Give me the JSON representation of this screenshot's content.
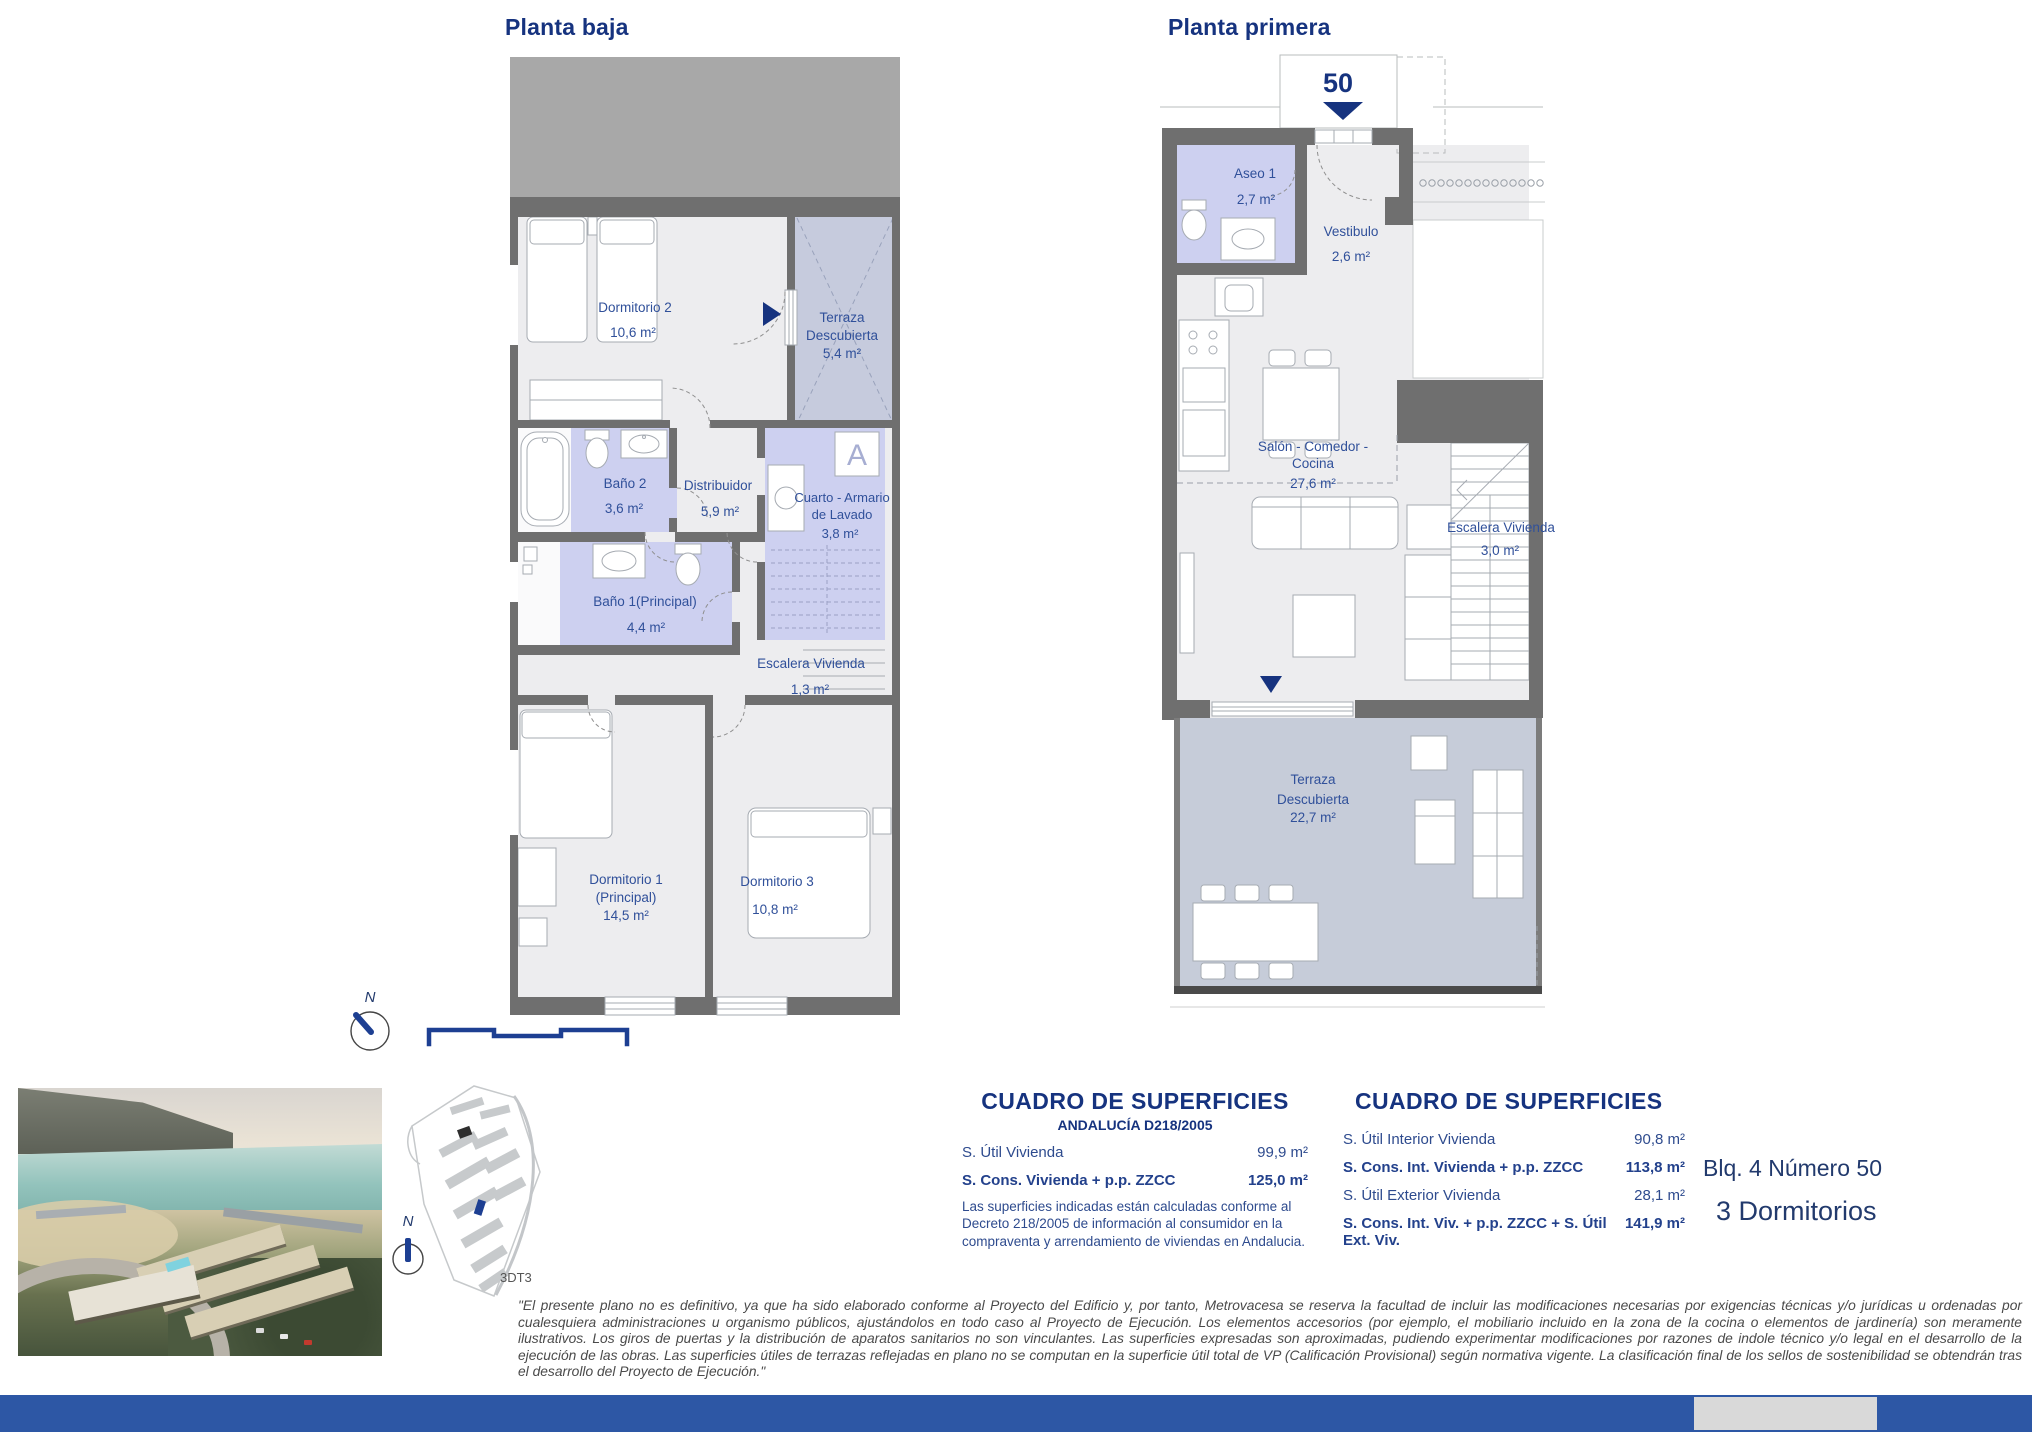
{
  "header": {
    "left_title": "Planta baja",
    "right_title": "Planta primera"
  },
  "planta_baja": {
    "north_label": "N",
    "armario_symbol": "A",
    "rooms": {
      "dormitorio2": {
        "name": "Dormitorio 2",
        "area": "10,6 m²"
      },
      "terraza": {
        "line1": "Terraza",
        "line2": "Descubierta",
        "area": "5,4 m²"
      },
      "bano2": {
        "name": "Baño 2",
        "area": "3,6 m²"
      },
      "distribuidor": {
        "name": "Distribuidor",
        "area": "5,9 m²"
      },
      "cuarto_lavado": {
        "line1": "Cuarto - Armario",
        "line2": "de Lavado",
        "area": "3,8 m²"
      },
      "bano1": {
        "name": "Baño 1(Principal)",
        "area": "4,4 m²"
      },
      "escalera": {
        "name": "Escalera Vivienda",
        "area": "1,3 m²"
      },
      "dormitorio1": {
        "line1": "Dormitorio 1",
        "line2": "(Principal)",
        "area": "14,5 m²"
      },
      "dormitorio3": {
        "name": "Dormitorio 3",
        "area": "10,8 m²"
      }
    }
  },
  "planta_primera": {
    "unit_number": "50",
    "rooms": {
      "aseo1": {
        "name": "Aseo 1",
        "area": "2,7 m²"
      },
      "vestibulo": {
        "name": "Vestibulo",
        "area": "2,6 m²"
      },
      "salon": {
        "line1": "Salón - Comedor -",
        "line2": "Cocina",
        "area": "27,6 m²"
      },
      "escalera": {
        "name": "Escalera Vivienda",
        "area": "3,0 m²"
      },
      "terraza": {
        "line1": "Terraza",
        "line2": "Descubierta",
        "area": "22,7 m²"
      }
    }
  },
  "surface_table_left": {
    "title": "CUADRO DE SUPERFICIES",
    "subtitle": "ANDALUCÍA D218/2005",
    "rows": [
      {
        "label": "S. Útil Vivienda",
        "value": "99,9 m²"
      },
      {
        "label": "S. Cons. Vivienda + p.p. ZZCC",
        "value": "125,0 m²"
      }
    ],
    "note": "Las superficies indicadas están calculadas conforme al Decreto 218/2005 de información al consumidor en la compraventa y arrendamiento de viviendas en Andalucia."
  },
  "surface_table_right": {
    "title": "CUADRO DE SUPERFICIES",
    "rows": [
      {
        "label": "S. Útil Interior Vivienda",
        "value": "90,8 m²"
      },
      {
        "label": "S. Cons. Int. Vivienda + p.p. ZZCC",
        "value": "113,8 m²"
      },
      {
        "label": "S. Útil Exterior Vivienda",
        "value": "28,1 m²"
      },
      {
        "label": "S. Cons. Int. Viv. + p.p. ZZCC + S. Útil Ext. Viv.",
        "value": "141,9 m²"
      }
    ]
  },
  "unit_info": {
    "block": "Blq. 4 Número 50",
    "bedrooms": "3 Dormitorios"
  },
  "site_plan": {
    "code": "3DT3",
    "north_label": "N"
  },
  "disclaimer": "\"El presente plano no es definitivo, ya que ha sido elaborado conforme al Proyecto del Edificio y, por tanto, Metrovacesa se reserva la facultad de incluir las modificaciones necesarias por exigencias técnicas y/o jurídicas u ordenadas por cualesquiera administraciones u organismo públicos, ajustándolos en todo caso al Proyecto de Ejecución. Los elementos accesorios (por ejemplo, el mobiliario incluido en la zona de la cocina o elementos de jardinería) son meramente ilustrativos. Los giros de puertas y la distribución de aparatos sanitarios no son vinculantes. Las superficies expresadas son aproximadas, pudiendo experimentar modificaciones por razones de indole técnico y/o legal en el desarrollo de la ejecución de las obras. Las superficies útiles de terrazas reflejadas en plano no se computan en la superficie útil total de VP (Calificación Provisional) según normativa vigente. La clasificación final de los sellos de sostenibilidad se obtendrán tras el desarrollo del Proyecto de Ejecución.\"",
  "colors": {
    "accent_navy": "#16337f",
    "label_navy": "#30509a",
    "wall_gray": "#6f6f6f",
    "room_highlight": "#cdd0f0",
    "terrace_fill": "#c6ccd9",
    "footer_bar": "#2d57a5"
  }
}
